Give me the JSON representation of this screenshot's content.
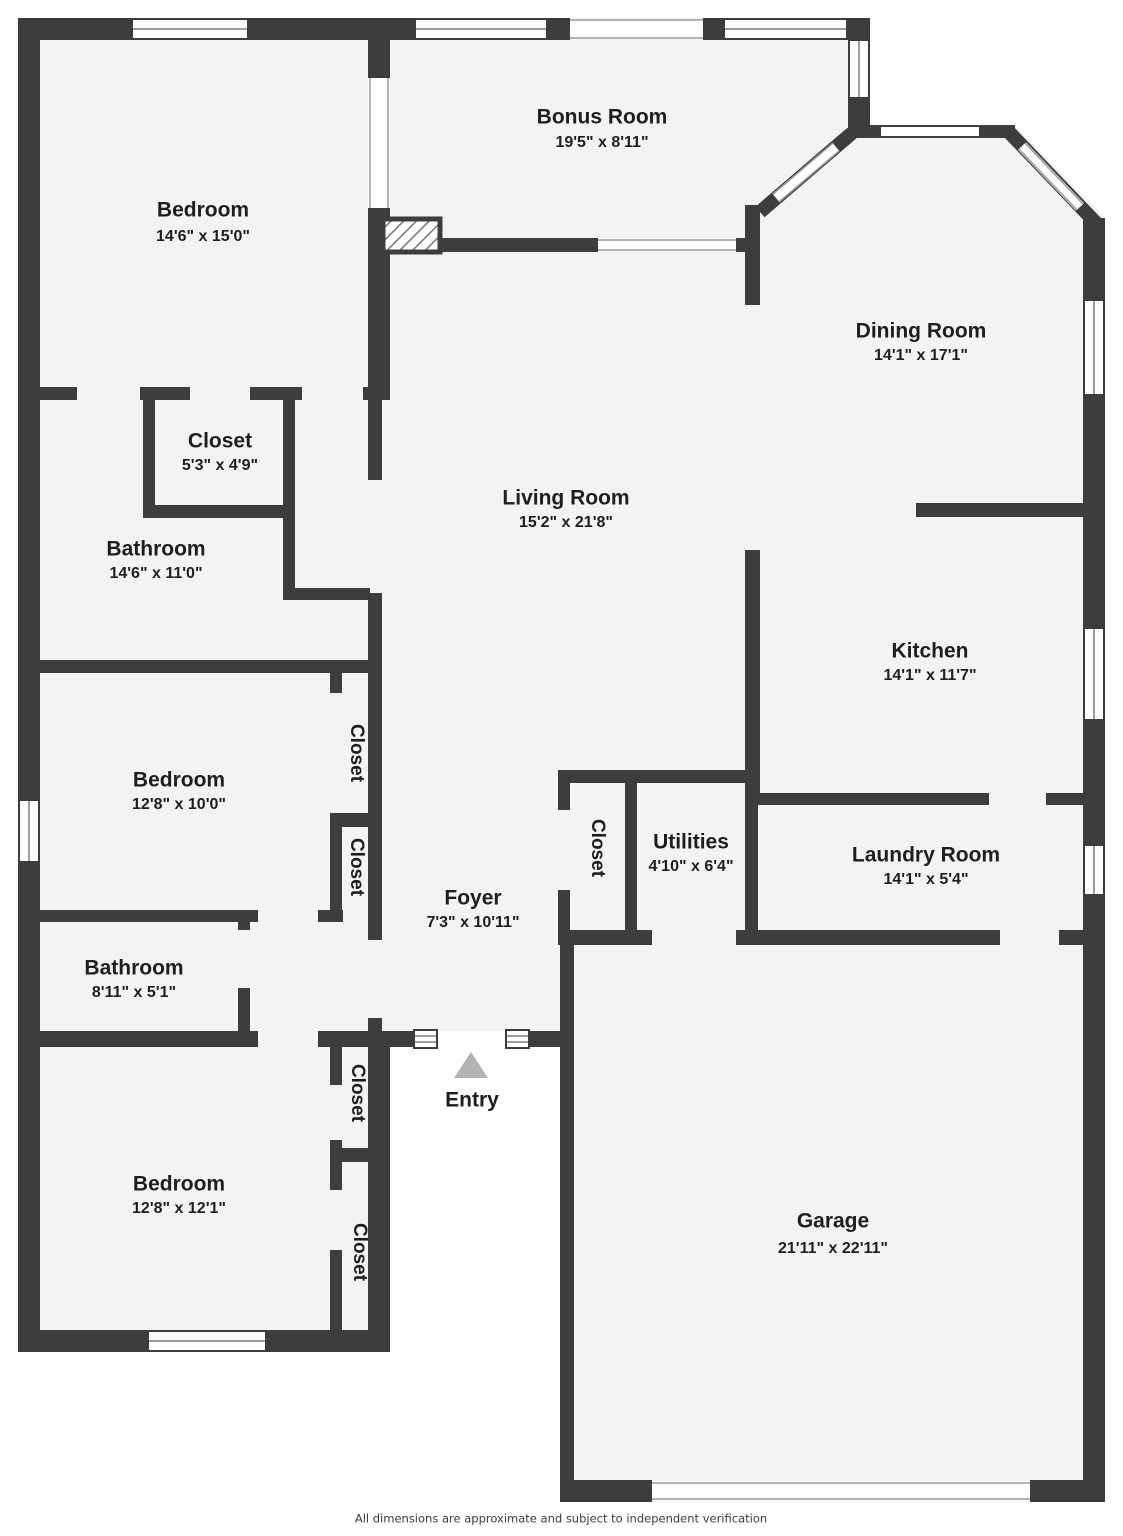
{
  "title": "Floor plan",
  "colors": {
    "wall": "#3d3d3d",
    "floor": "#f3f3f3",
    "background": "#ffffff",
    "opening_line": "#9a9a9a",
    "entry_arrow": "#b3b3b3",
    "label_text": "#1e1e1e"
  },
  "rooms": [
    {
      "name": "Bedroom",
      "dims": "14'6\" x 15'0\""
    },
    {
      "name": "Bonus Room",
      "dims": "19'5\" x 8'11\""
    },
    {
      "name": "Dining Room",
      "dims": "14'1\" x 17'1\""
    },
    {
      "name": "Closet",
      "dims": "5'3\" x 4'9\""
    },
    {
      "name": "Living Room",
      "dims": "15'2\" x 21'8\""
    },
    {
      "name": "Bathroom",
      "dims": "14'6\" x 11'0\""
    },
    {
      "name": "Kitchen",
      "dims": "14'1\" x 11'7\""
    },
    {
      "name": "Bedroom",
      "dims": "12'8\" x 10'0\""
    },
    {
      "name": "Foyer",
      "dims": "7'3\" x 10'11\""
    },
    {
      "name": "Utilities",
      "dims": "4'10\" x 6'4\""
    },
    {
      "name": "Laundry Room",
      "dims": "14'1\" x 5'4\""
    },
    {
      "name": "Bathroom",
      "dims": "8'11\" x 5'1\""
    },
    {
      "name": "Bedroom",
      "dims": "12'8\" x 12'1\""
    },
    {
      "name": "Garage",
      "dims": "21'11\" x 22'11\""
    }
  ],
  "closet_labels": [
    "Closet",
    "Closet",
    "Closet",
    "Closet",
    "Closet"
  ],
  "entry": {
    "label": "Entry"
  },
  "footer": {
    "disclaimer": "All dimensions are approximate and subject to independent verification"
  }
}
